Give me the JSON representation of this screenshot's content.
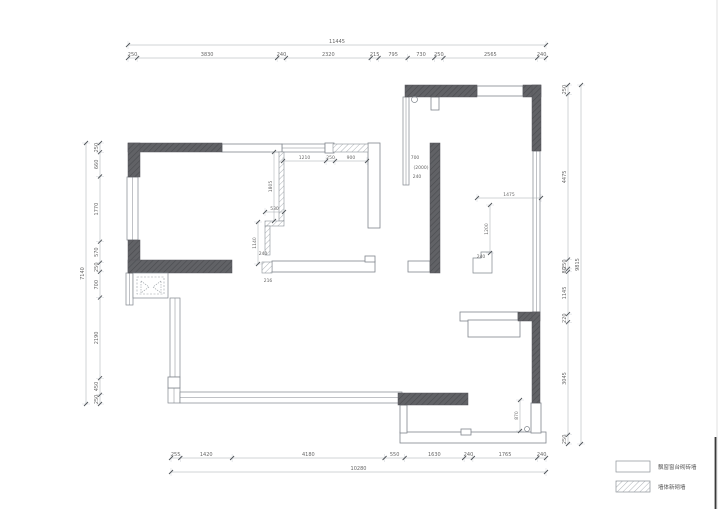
{
  "drawing": {
    "dims": {
      "top": {
        "total": "11445",
        "segments": [
          "250",
          "3830",
          "240",
          "2320",
          "215",
          "795",
          "730",
          "250",
          "2565",
          "240"
        ]
      },
      "bottom": {
        "total": "10280",
        "segments": [
          "255",
          "1420",
          "4180",
          "550",
          "1630",
          "240",
          "1765",
          "240"
        ]
      },
      "left": {
        "total": "7140",
        "segments": [
          "250",
          "660",
          "1770",
          "570",
          "250",
          "700",
          "2190",
          "450",
          "250"
        ]
      },
      "right": {
        "total": "9815",
        "segments": [
          "250",
          "4475",
          "250",
          "80",
          "1145",
          "220",
          "3045",
          "250"
        ]
      }
    },
    "interior": {
      "rows": [
        {
          "values": [
            "1210",
            "250",
            "900"
          ]
        },
        {
          "values": [
            "1805"
          ]
        },
        {
          "values": [
            "530"
          ]
        },
        {
          "values": [
            "1140"
          ]
        },
        {
          "values": [
            "1475"
          ]
        },
        {
          "values": [
            "1200"
          ]
        },
        {
          "values": [
            "870"
          ]
        }
      ],
      "texts": [
        "700",
        "(2000)",
        "240",
        "240",
        "216",
        "240"
      ]
    },
    "legend": {
      "items": [
        {
          "swatch": "empty",
          "label": "飘窗窗台砌砖墙"
        },
        {
          "swatch": "hatch",
          "label": "墙体新砌墙"
        }
      ]
    },
    "colors": {
      "wall_dark": "#5d5e62",
      "new_wall_hatch": "#9aa0a6",
      "line": "#80868d",
      "dim_text": "#666666"
    }
  }
}
